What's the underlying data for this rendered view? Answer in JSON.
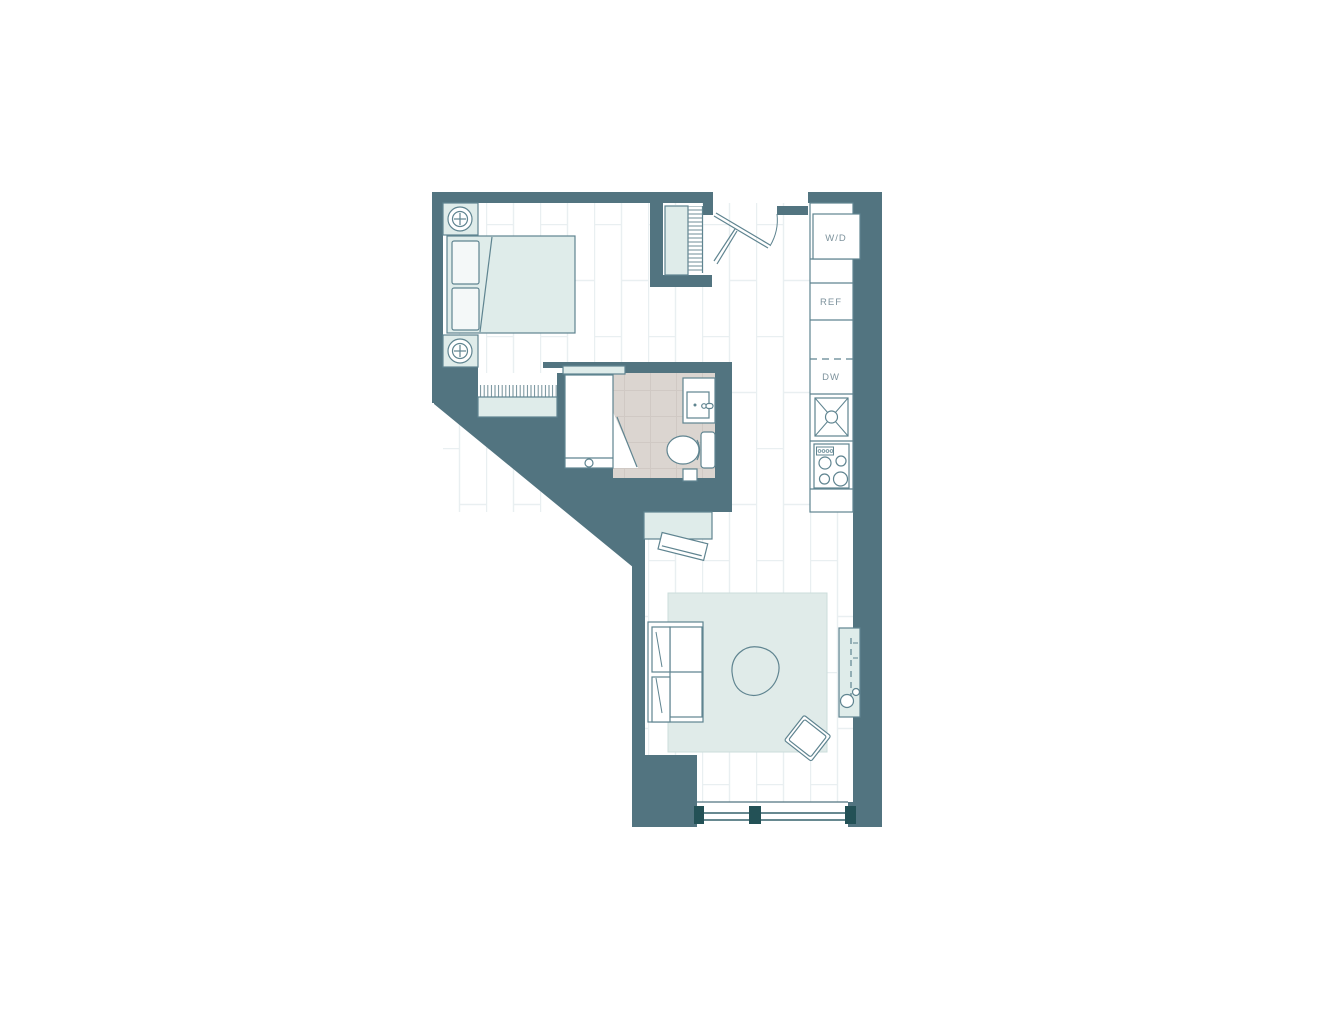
{
  "floor_plan": {
    "appliance_labels": {
      "washer_dryer": "W/D",
      "refrigerator": "REF",
      "dishwasher": "DW"
    },
    "colors": {
      "wall": "#527480",
      "furniture_stroke": "#5f8490",
      "furniture_fill": "#dfecea",
      "bathroom_floor": "#dbd5d0",
      "window_mullion": "#235156",
      "label_text": "#7d929c",
      "floor_plank_line": "#e9eff1"
    }
  }
}
